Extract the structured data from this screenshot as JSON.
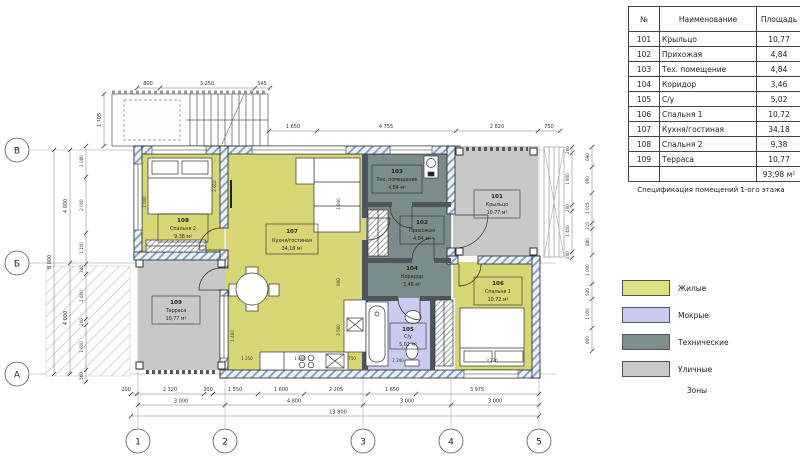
{
  "colors": {
    "residential": "#d6d675",
    "wet": "#cbcaf0",
    "technical": "#7b8d8b",
    "street": "#c8c8c8"
  },
  "legend": {
    "items": [
      {
        "label": "Жилые",
        "color": "#dede84"
      },
      {
        "label": "Мокрые",
        "color": "#c9c9f2"
      },
      {
        "label": "Технические",
        "color": "#7e908e"
      },
      {
        "label": "Уличные",
        "color": "#c9c9c9"
      }
    ],
    "caption": "Зоны"
  },
  "table": {
    "headers": {
      "num": "№",
      "name": "Наименование",
      "area": "Площадь"
    },
    "rows": [
      {
        "num": "101",
        "name": "Крыльцо",
        "area": "10,77"
      },
      {
        "num": "102",
        "name": "Прихожая",
        "area": "4,84"
      },
      {
        "num": "103",
        "name": "Тех. помещение",
        "area": "4,84"
      },
      {
        "num": "104",
        "name": "Коридор",
        "area": "3,46"
      },
      {
        "num": "105",
        "name": "С/у",
        "area": "5,02"
      },
      {
        "num": "106",
        "name": "Спальня 1",
        "area": "10,72"
      },
      {
        "num": "107",
        "name": "Кухня/гостиная",
        "area": "34,18"
      },
      {
        "num": "108",
        "name": "Спальня 2",
        "area": "9,38"
      },
      {
        "num": "109",
        "name": "Терраса",
        "area": "10,77"
      }
    ],
    "total": "93,98 м²",
    "caption": "Спецификация помещений 1-ого этажа"
  },
  "rooms": {
    "r101": {
      "num": "101",
      "name": "Крыльцо",
      "area": "10,77 м²"
    },
    "r102": {
      "num": "102",
      "name": "Прихожая",
      "area": "4,84 м²"
    },
    "r103": {
      "num": "103",
      "name": "Тех. помещение",
      "area": "4,84 м²"
    },
    "r104": {
      "num": "104",
      "name": "Коридор",
      "area": "3,46 м²"
    },
    "r105": {
      "num": "105",
      "name": "С/у",
      "area": "5,02 м²"
    },
    "r106": {
      "num": "106",
      "name": "Спальня 1",
      "area": "10,72 м²"
    },
    "r107": {
      "num": "107",
      "name": "Кухня/гостиная",
      "area": "34,18 м²"
    },
    "r108": {
      "num": "108",
      "name": "Спальня 2",
      "area": "9,38 м²"
    },
    "r109": {
      "num": "109",
      "name": "Терраса",
      "area": "10,77 м²"
    }
  },
  "plan": {
    "grid": {
      "cols": [
        "1",
        "2",
        "3",
        "4",
        "5"
      ],
      "rows": [
        "В",
        "Б",
        "А"
      ]
    },
    "dims": {
      "st": [
        "800",
        "3 250",
        "545"
      ],
      "sl": "1 705",
      "top": [
        "1 650",
        "4 755",
        "2 820",
        "750"
      ],
      "b1": [
        "200",
        "2 320",
        "300",
        "1 550",
        "1 600",
        "2 205",
        "1 650",
        "3 975"
      ],
      "b2": [
        "3 000",
        "4 800",
        "3 000",
        "3 000"
      ],
      "bt": "13 800",
      "lo": "8 000",
      "lm": [
        "4 000",
        "4 000"
      ],
      "li": [
        "1 080",
        "2 000",
        "1 100",
        "340",
        "1 600",
        "200",
        "1 600",
        "560"
      ],
      "ri": [
        "200",
        "1 800",
        "200",
        "1 400",
        "200"
      ],
      "ro": [
        "690",
        "900",
        "1 015",
        "215",
        "880",
        "1 000",
        "520",
        "1 000",
        "800"
      ],
      "in": [
        "2 000",
        "2 610",
        "1 940",
        "900",
        "2 560",
        "1 460",
        "1 250",
        "1 600",
        "750",
        "2 240",
        "3 220"
      ]
    }
  }
}
